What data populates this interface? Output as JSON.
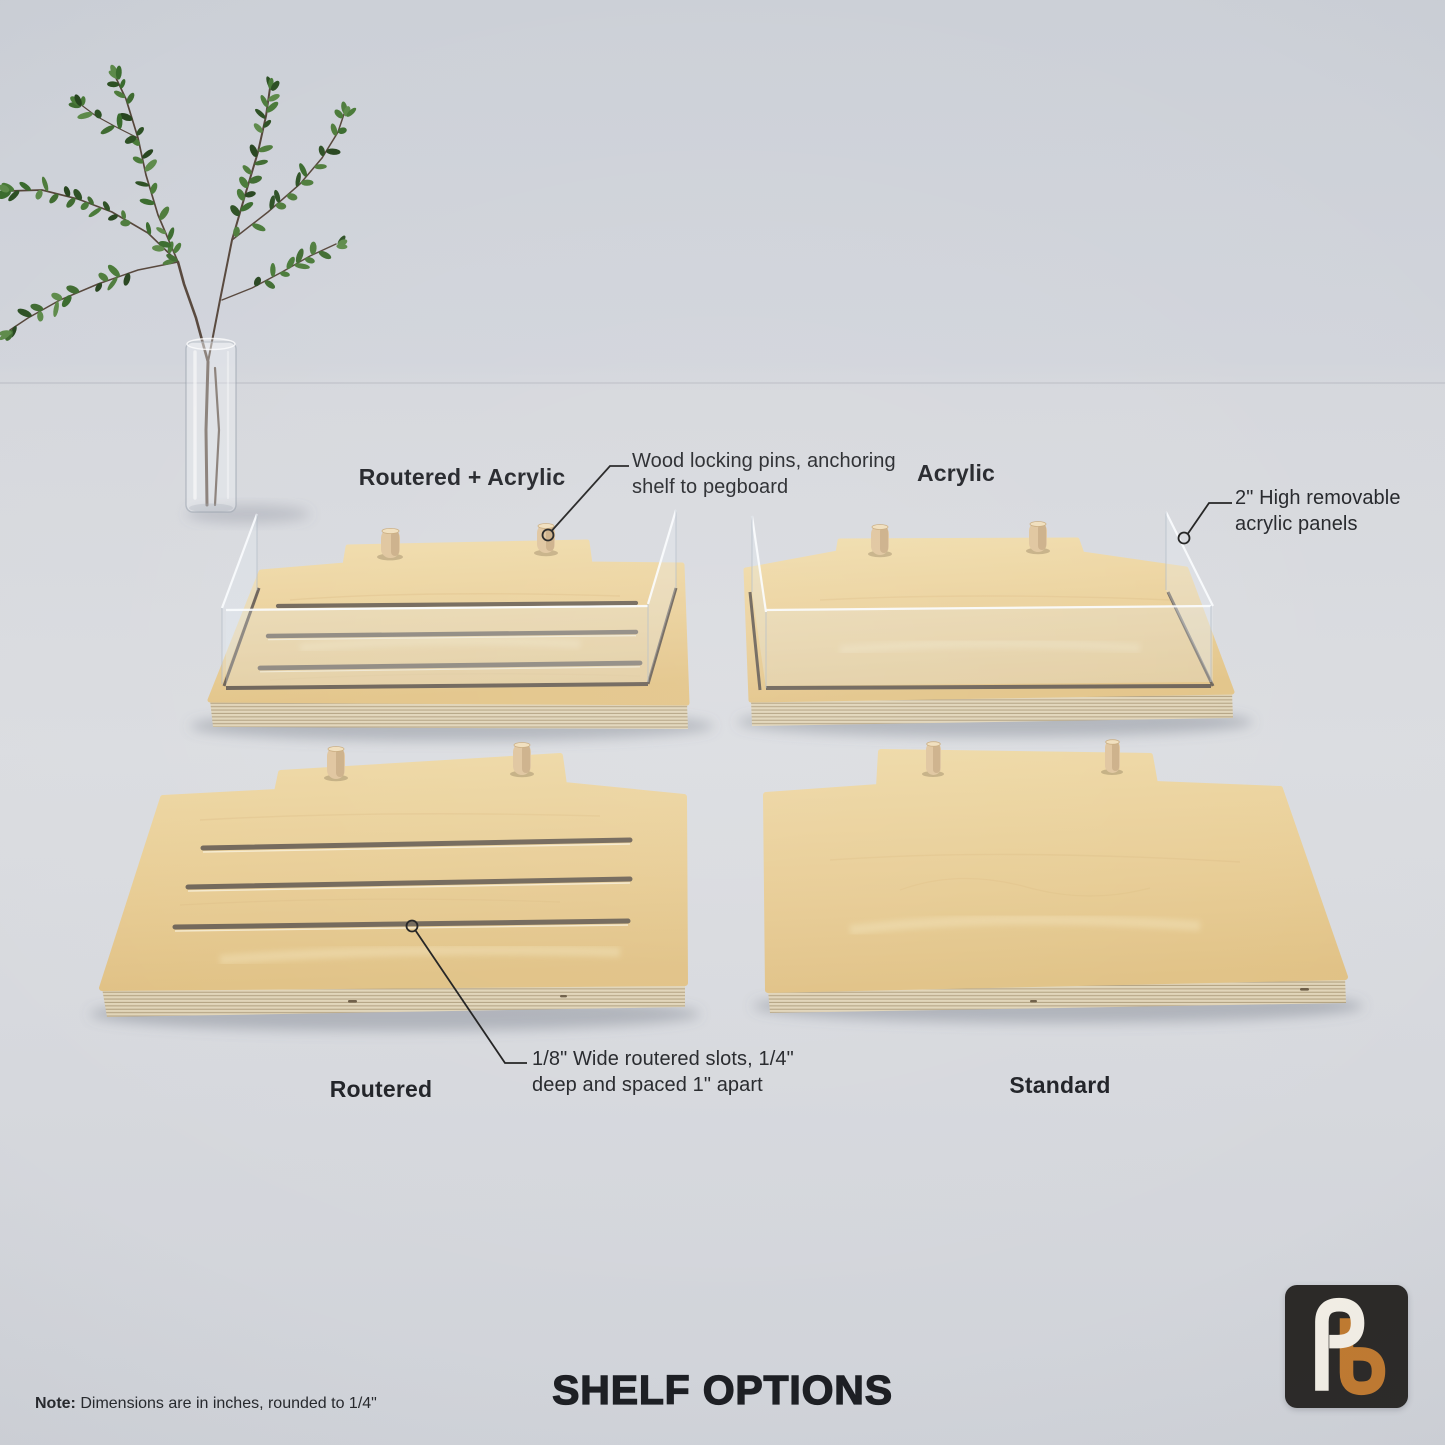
{
  "page": {
    "title": "SHELF OPTIONS",
    "note": {
      "label": "Note:",
      "text": " Dimensions are in inches, rounded to 1/4\""
    }
  },
  "shelves": {
    "routered_acrylic": {
      "label": "Routered + Acrylic"
    },
    "acrylic": {
      "label": "Acrylic"
    },
    "routered": {
      "label": "Routered"
    },
    "standard": {
      "label": "Standard"
    }
  },
  "callouts": {
    "pins": {
      "text": "Wood locking pins, anchoring shelf to pegboard"
    },
    "panels": {
      "text": "2\" High removable acrylic panels"
    },
    "slots": {
      "text": "1/8\" Wide routered slots, 1/4\" deep and spaced 1\" apart"
    }
  },
  "logo": {
    "monogram": "pb-monogram"
  },
  "colors": {
    "ink": "#1d1f24",
    "line": "#1c1c1c",
    "wood_hi": "#f0dcab",
    "wood_mid": "#e8cc94",
    "wood_lo": "#dfc081",
    "ply_light": "#e0d4b8",
    "ply_dark": "#b3a281",
    "pin": "#dfc49c",
    "slot": "#6f6456",
    "acrylic_edge": "#fbfdff",
    "stem": "#55453a",
    "logo_bg": "#2b2927",
    "logo_p": "#f3efe6",
    "logo_b": "#c07a30",
    "leaf_palette": [
      "#2d5024",
      "#3a6b2e",
      "#3f6b31",
      "#4e7c3c",
      "#5d8a4a",
      "#27451f",
      "#497a38"
    ]
  }
}
